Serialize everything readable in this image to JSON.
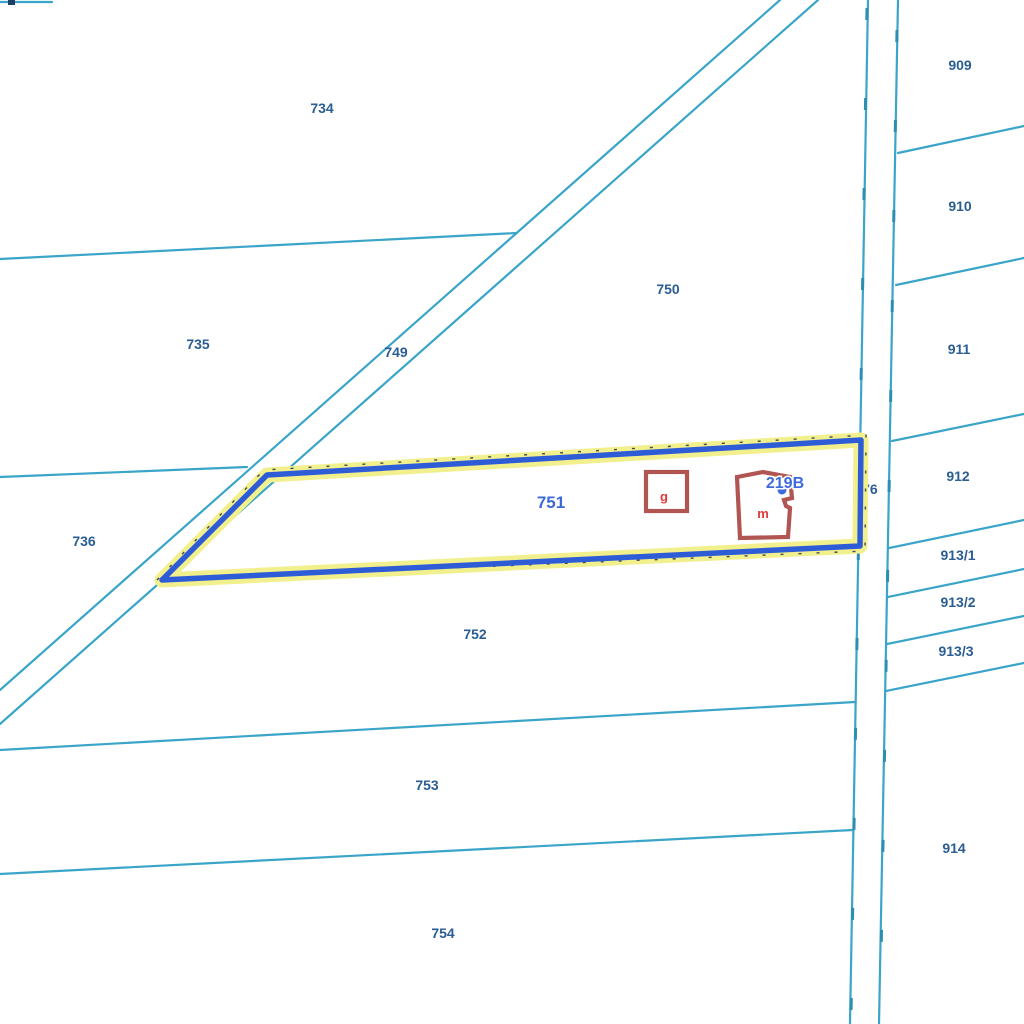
{
  "map": {
    "type": "cadastral-parcel-map",
    "background_color": "#ffffff",
    "colors": {
      "boundary_line": "#3aa5c8",
      "parcel_number_label": "#2a5d93",
      "selected_parcel_outline": "#2e5cd7",
      "selected_parcel_halo": "#f2ef8d",
      "building_outline": "#b05552",
      "building_letter": "#e03a3a",
      "address_point": "#3d6bdc"
    },
    "labels": {
      "p734": "734",
      "p735": "735",
      "p736": "736",
      "p749": "749",
      "p750": "750",
      "p751": "751",
      "p752": "752",
      "p753": "753",
      "p754": "754",
      "p776": "776",
      "p909": "909",
      "p910": "910",
      "p911": "911",
      "p912": "912",
      "p913_1": "913/1",
      "p913_2": "913/2",
      "p913_3": "913/3",
      "p914": "914"
    },
    "highlighted_parcel": {
      "number": "751",
      "address_point_label": "219B",
      "buildings": [
        {
          "letter": "g"
        },
        {
          "letter": "m"
        }
      ]
    }
  }
}
